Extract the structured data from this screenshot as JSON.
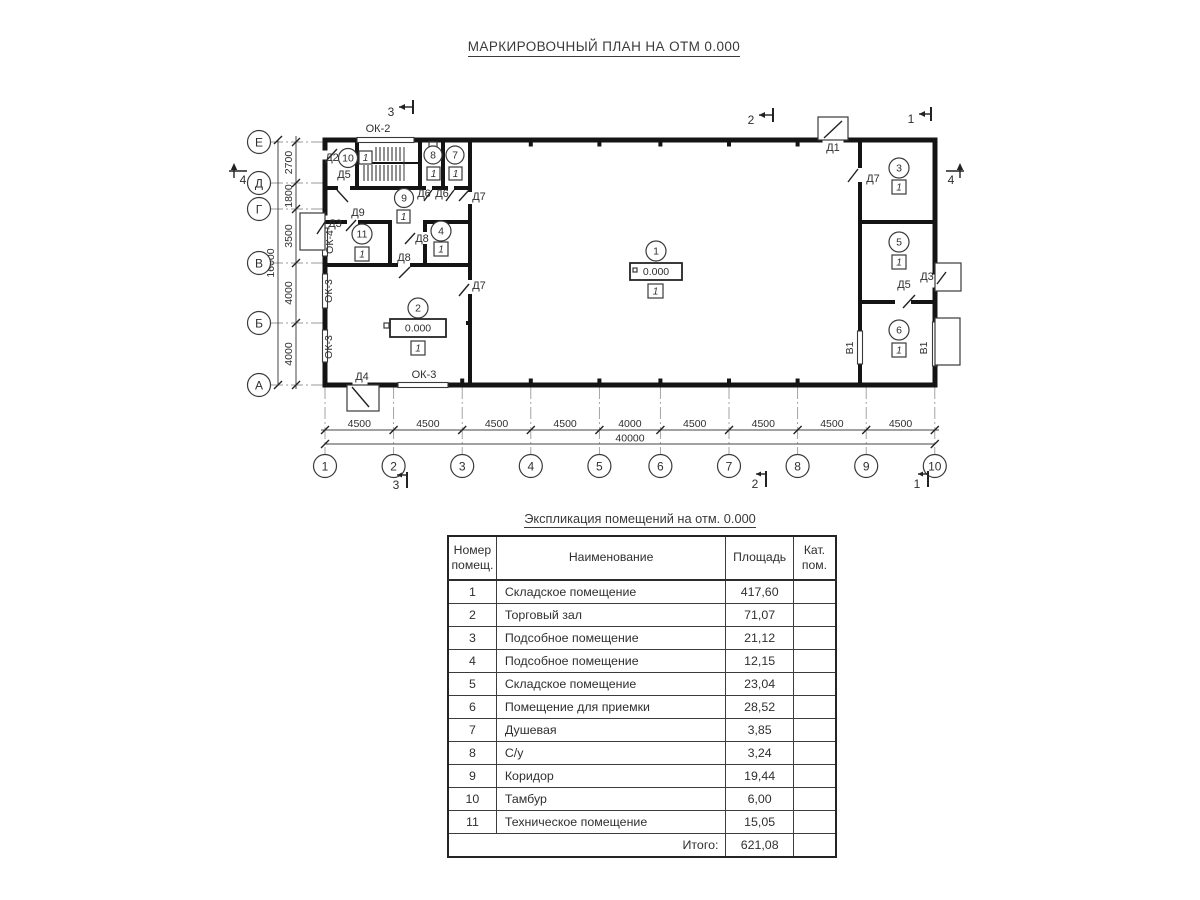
{
  "page": {
    "title": "МАРКИРОВОЧНЫЙ ПЛАН НА ОТМ 0.000"
  },
  "plan": {
    "axis_letters": [
      "Е",
      "Д",
      "Г",
      "В",
      "Б",
      "А"
    ],
    "axis_numbers": [
      "1",
      "2",
      "3",
      "4",
      "5",
      "6",
      "7",
      "8",
      "9",
      "10"
    ],
    "dims_left": [
      "2700",
      "1800",
      "3500",
      "4000",
      "4000"
    ],
    "dims_left_total": "16000",
    "dims_bottom": [
      "4500",
      "4500",
      "4500",
      "4500",
      "4000",
      "4500",
      "4500",
      "4500",
      "4500"
    ],
    "dims_bottom_total": "40000",
    "rooms": [
      "1",
      "2",
      "3",
      "4",
      "5",
      "6",
      "7",
      "8",
      "9",
      "10",
      "11"
    ],
    "category_mark": "1",
    "elevation_mark": "0.000",
    "doors": {
      "d1": "Д1",
      "d2": "Д2",
      "d3": "Д3",
      "d4": "Д4",
      "d5": "Д5",
      "d6": "Д6",
      "d7": "Д7",
      "d8": "Д8",
      "d9": "Д9"
    },
    "windows": {
      "ok2": "ОК-2",
      "ok3": "ОК-3",
      "ok4": "ОК-4"
    },
    "vent": "В1",
    "sections": {
      "s1": "1",
      "s2": "2",
      "s3": "3",
      "s4": "4"
    }
  },
  "schedule": {
    "title": "Экспликация помещений на отм. 0.000",
    "headers": [
      "Номер помещ.",
      "Наименование",
      "Площадь",
      "Кат. пом."
    ],
    "rows": [
      [
        "1",
        "Складское помещение",
        "417,60",
        ""
      ],
      [
        "2",
        "Торговый зал",
        "71,07",
        ""
      ],
      [
        "3",
        "Подсобное помещение",
        "21,12",
        ""
      ],
      [
        "4",
        "Подсобное помещение",
        "12,15",
        ""
      ],
      [
        "5",
        "Складское помещение",
        "23,04",
        ""
      ],
      [
        "6",
        "Помещение для приемки",
        "28,52",
        ""
      ],
      [
        "7",
        "Душевая",
        "3,85",
        ""
      ],
      [
        "8",
        "С/у",
        "3,24",
        ""
      ],
      [
        "9",
        "Коридор",
        "19,44",
        ""
      ],
      [
        "10",
        "Тамбур",
        "6,00",
        ""
      ],
      [
        "11",
        "Техническое помещение",
        "15,05",
        ""
      ]
    ],
    "total_label": "Итого:",
    "total_value": "621,08"
  }
}
